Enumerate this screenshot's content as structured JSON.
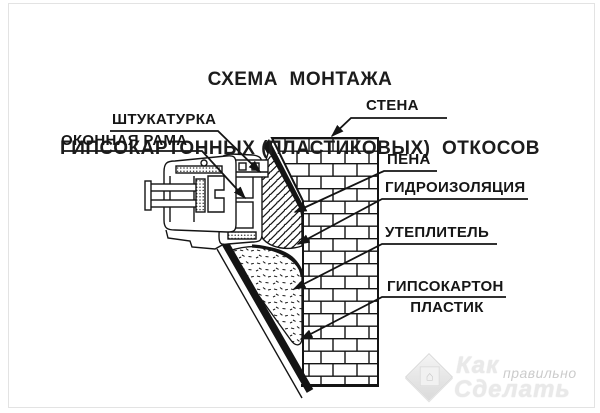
{
  "title": {
    "line1": "СХЕМА  МОНТАЖА",
    "line2": "ГИПСОКАРТОННЫХ (ПЛАСТИКОВЫХ)  ОТКОСОВ"
  },
  "labels": {
    "plaster": "ШТУКАТУРКА",
    "window_frame": "ОКОННАЯ РАМА",
    "wall": "СТЕНА",
    "foam": "ПЕНА",
    "waterproofing": "ГИДРОИЗОЛЯЦИЯ",
    "insulation": "УТЕПЛИТЕЛЬ",
    "drywall": "ГИПСОКАРТОН",
    "plastic": "ПЛАСТИК"
  },
  "watermark": {
    "word1": "Как",
    "word2": "правильно",
    "word3": "Сделать",
    "logo": "house-diamond-logo"
  },
  "colors": {
    "ink": "#161616",
    "background": "#ffffff",
    "watermark_gray": "#c9c9c9"
  }
}
